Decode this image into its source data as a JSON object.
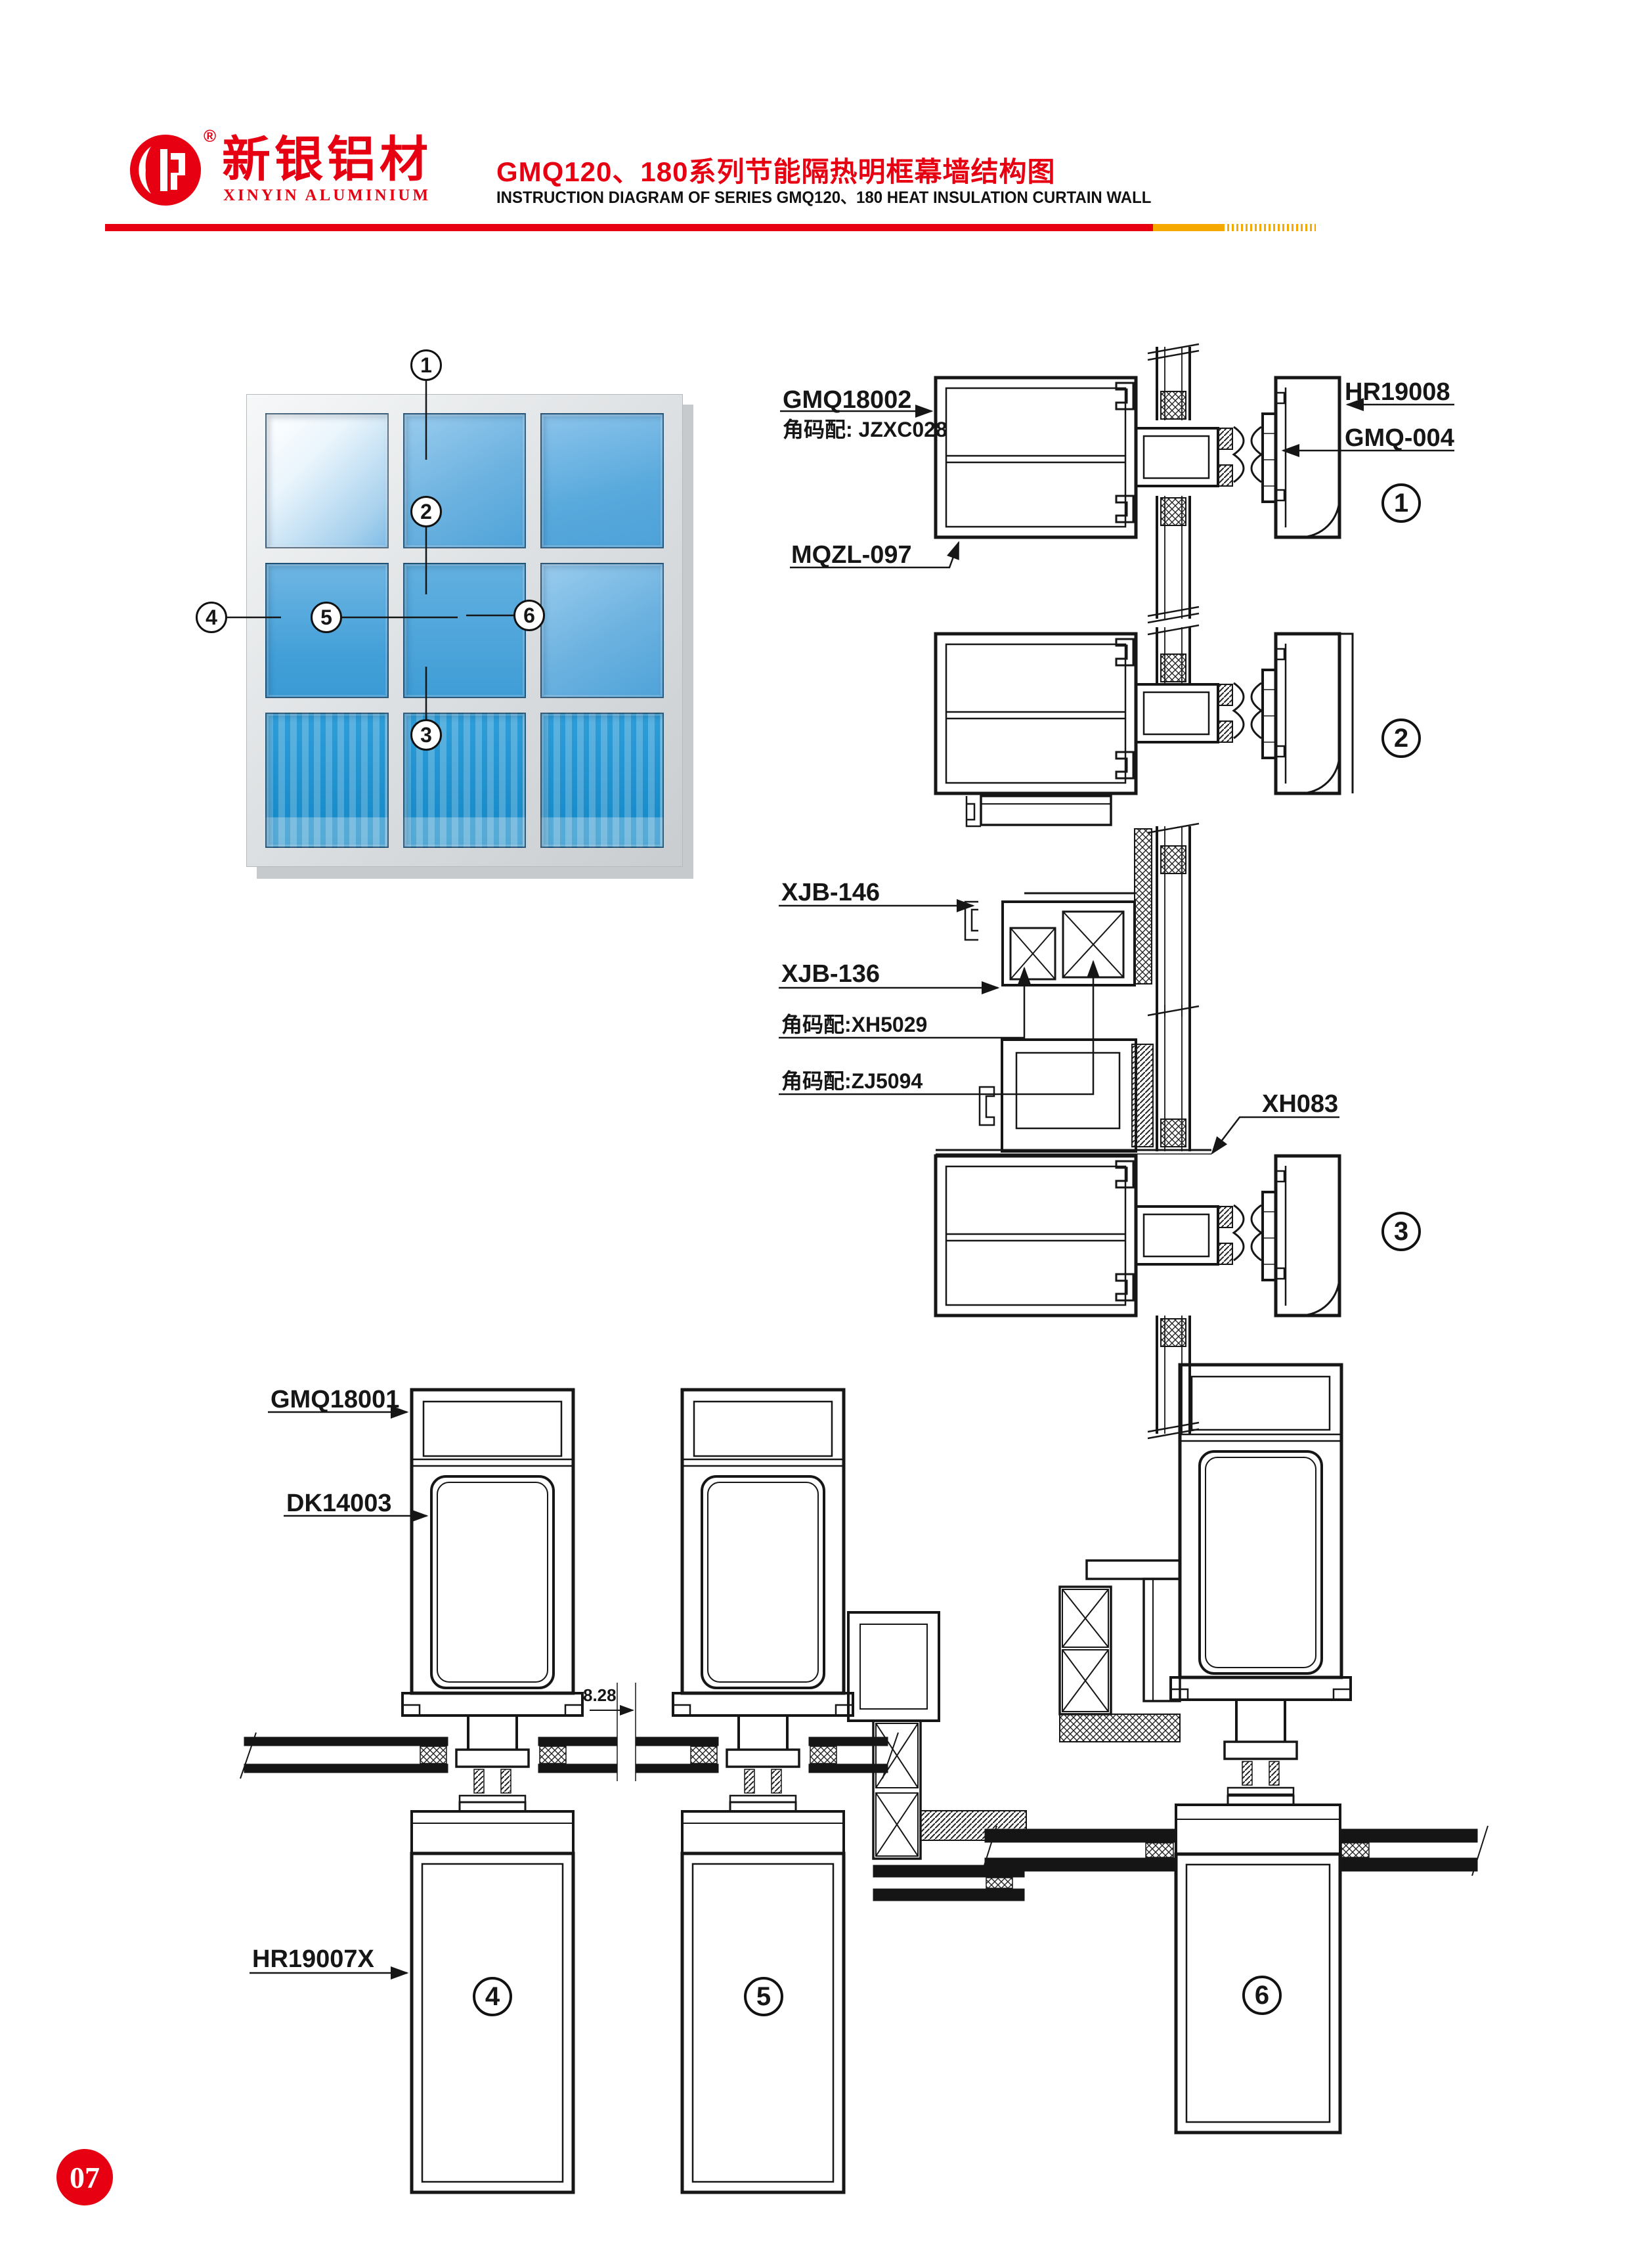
{
  "header": {
    "brand_cn": "新银铝材",
    "brand_en": "XINYIN ALUMINIUM",
    "registered": "®",
    "title_cn": "GMQ120、180系列节能隔热明框幕墙结构图",
    "title_en": "INSTRUCTION DIAGRAM OF SERIES GMQ120、180 HEAT INSULATION CURTAIN WALL",
    "accent_red": "#e60012",
    "accent_gold": "#f5a800"
  },
  "window": {
    "callouts": [
      {
        "n": "1"
      },
      {
        "n": "2"
      },
      {
        "n": "3"
      },
      {
        "n": "4"
      },
      {
        "n": "5"
      },
      {
        "n": "6"
      }
    ]
  },
  "labels": {
    "gmq18002": "GMQ18002",
    "jzxc028": "角码配: JZXC028",
    "mqzl097": "MQZL-097",
    "hr19008": "HR19008",
    "gmq004": "GMQ-004",
    "xjb146": "XJB-146",
    "xjb136": "XJB-136",
    "xh5029": "角码配:XH5029",
    "zj5094": "角码配:ZJ5094",
    "xh083": "XH083",
    "gmq18001": "GMQ18001",
    "dk14003": "DK14003",
    "dim828": "8.28",
    "hr19007x": "HR19007X"
  },
  "circles": {
    "d1": "1",
    "d2": "2",
    "d3": "3",
    "s4": "4",
    "s5": "5",
    "s6": "6"
  },
  "footer": {
    "page": "07"
  }
}
